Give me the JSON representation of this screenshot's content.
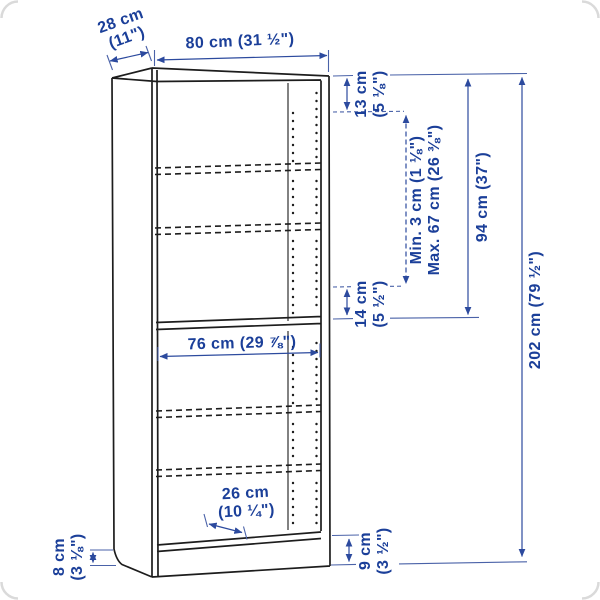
{
  "diagram": {
    "subject": "bookcase line drawing with dimension annotations",
    "colors": {
      "dimension_text": "#1b3f99",
      "dimension_line": "#4a62a8",
      "arrowhead": "#2c4a9e",
      "drawing_line": "#1d1d1d",
      "corner_border": "#dadada",
      "background": "#ffffff"
    },
    "dims": {
      "depth": {
        "l1": "28 cm",
        "l2": "(11\")"
      },
      "width": {
        "text": "80 cm (31 ½\")"
      },
      "top_gap": {
        "l1": "13 cm",
        "l2": "(5 ⅛\")"
      },
      "adjustable": {
        "l1": "Min. 3 cm (1 ⅛\")",
        "l2": "Max. 67 cm (26 ⅜\")"
      },
      "upper_height": {
        "text": "94 cm (37\")"
      },
      "total_height": {
        "text": "202 cm (79 ½\")"
      },
      "mid_gap": {
        "l1": "14 cm",
        "l2": "(5 ½\")"
      },
      "interior_width": {
        "text": "76 cm (29 ⅞\")"
      },
      "base_depth": {
        "l1": "26 cm",
        "l2": "(10 ¼\")"
      },
      "side_plinth": {
        "l1": "8 cm",
        "l2": "(3 ⅛\")"
      },
      "front_plinth": {
        "l1": "9 cm",
        "l2": "(3 ½\")"
      }
    }
  }
}
